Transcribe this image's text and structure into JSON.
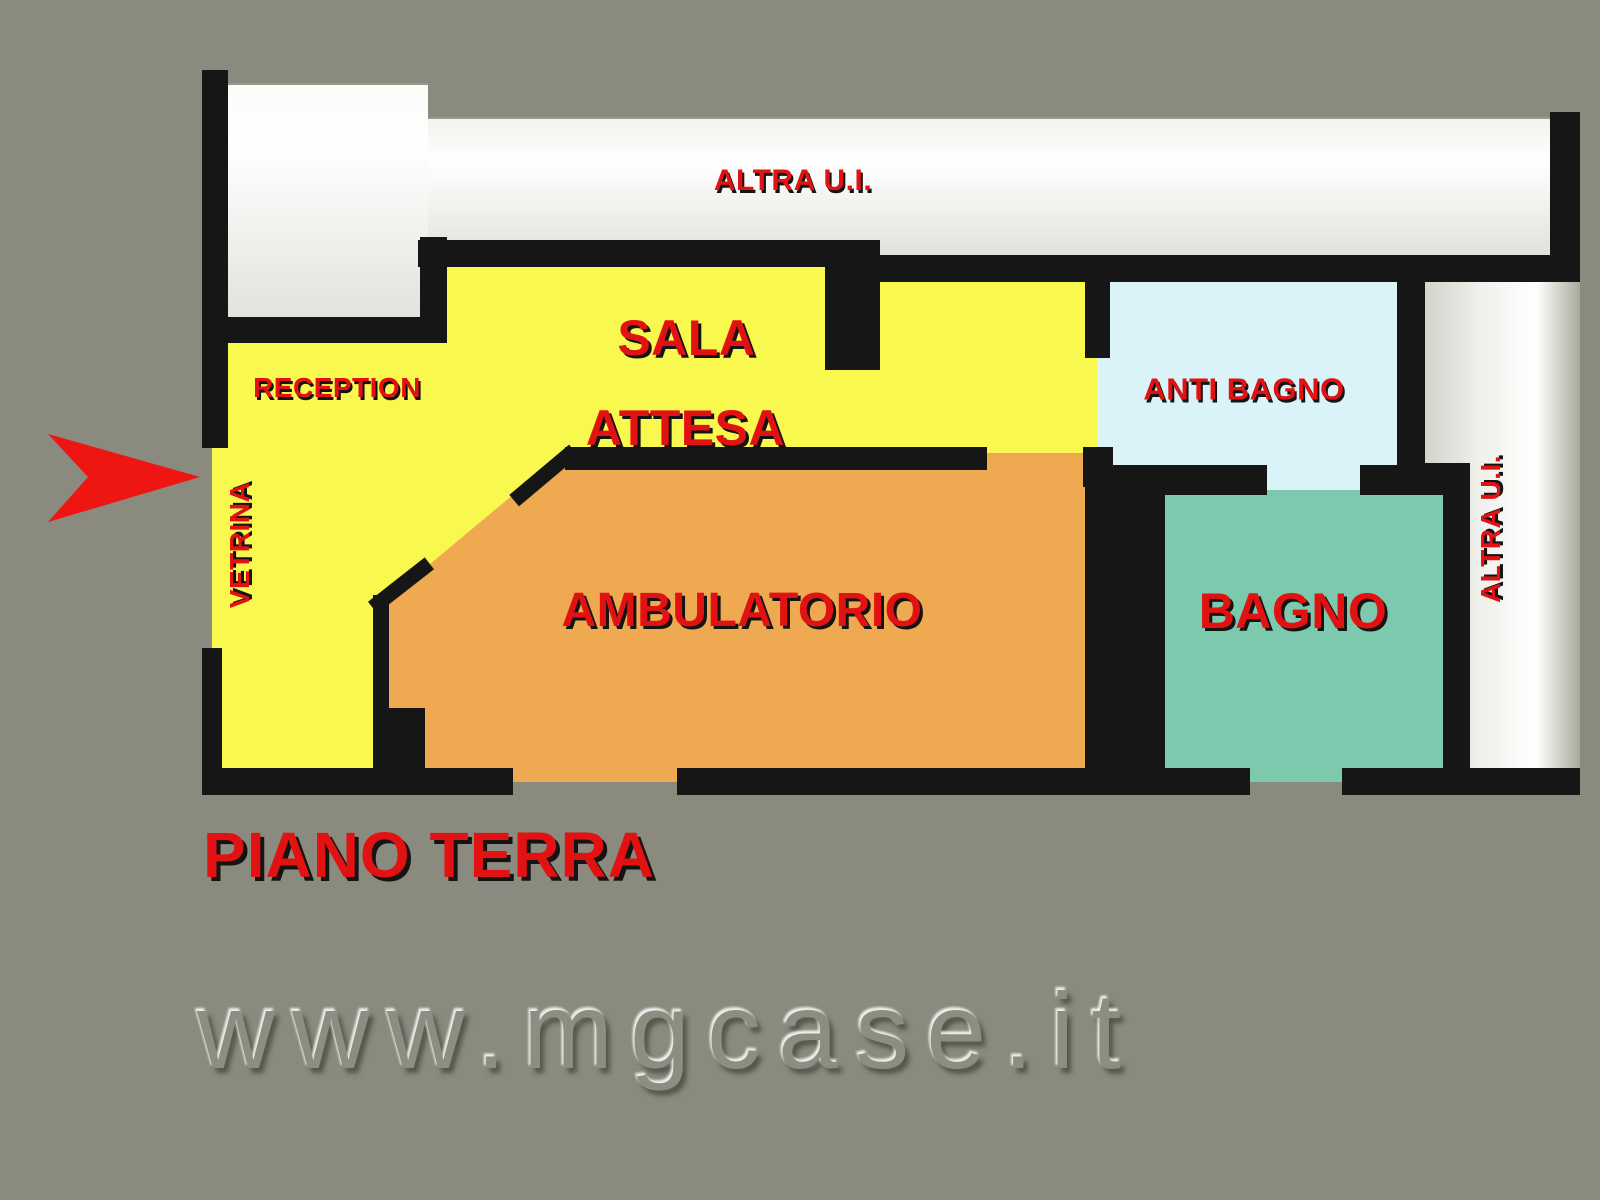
{
  "floorplan": {
    "floor_title": "PIANO TERRA",
    "rooms": {
      "altra_ui_top": "ALTRA U.I.",
      "reception": "RECEPTION",
      "sala_attesa_line1": "SALA",
      "sala_attesa_line2": "ATTESA",
      "vetrina": "VETRINA",
      "ambulatorio": "AMBULATORIO",
      "anti_bagno": "ANTI BAGNO",
      "bagno": "BAGNO",
      "altra_ui_right": "ALTRA U.I."
    },
    "colors": {
      "background": "#8a8a7e",
      "room_yellow": "#f8f84e",
      "room_orange": "#efa951",
      "room_cyan": "#d9f3f9",
      "room_teal": "#7dc9ad",
      "wall_black": "#161616",
      "label_red": "#e21212",
      "other_unit_white": "#ffffff",
      "entrance_arrow_red": "#ee1512"
    }
  },
  "watermark": {
    "text": "www.mgcase.it"
  }
}
